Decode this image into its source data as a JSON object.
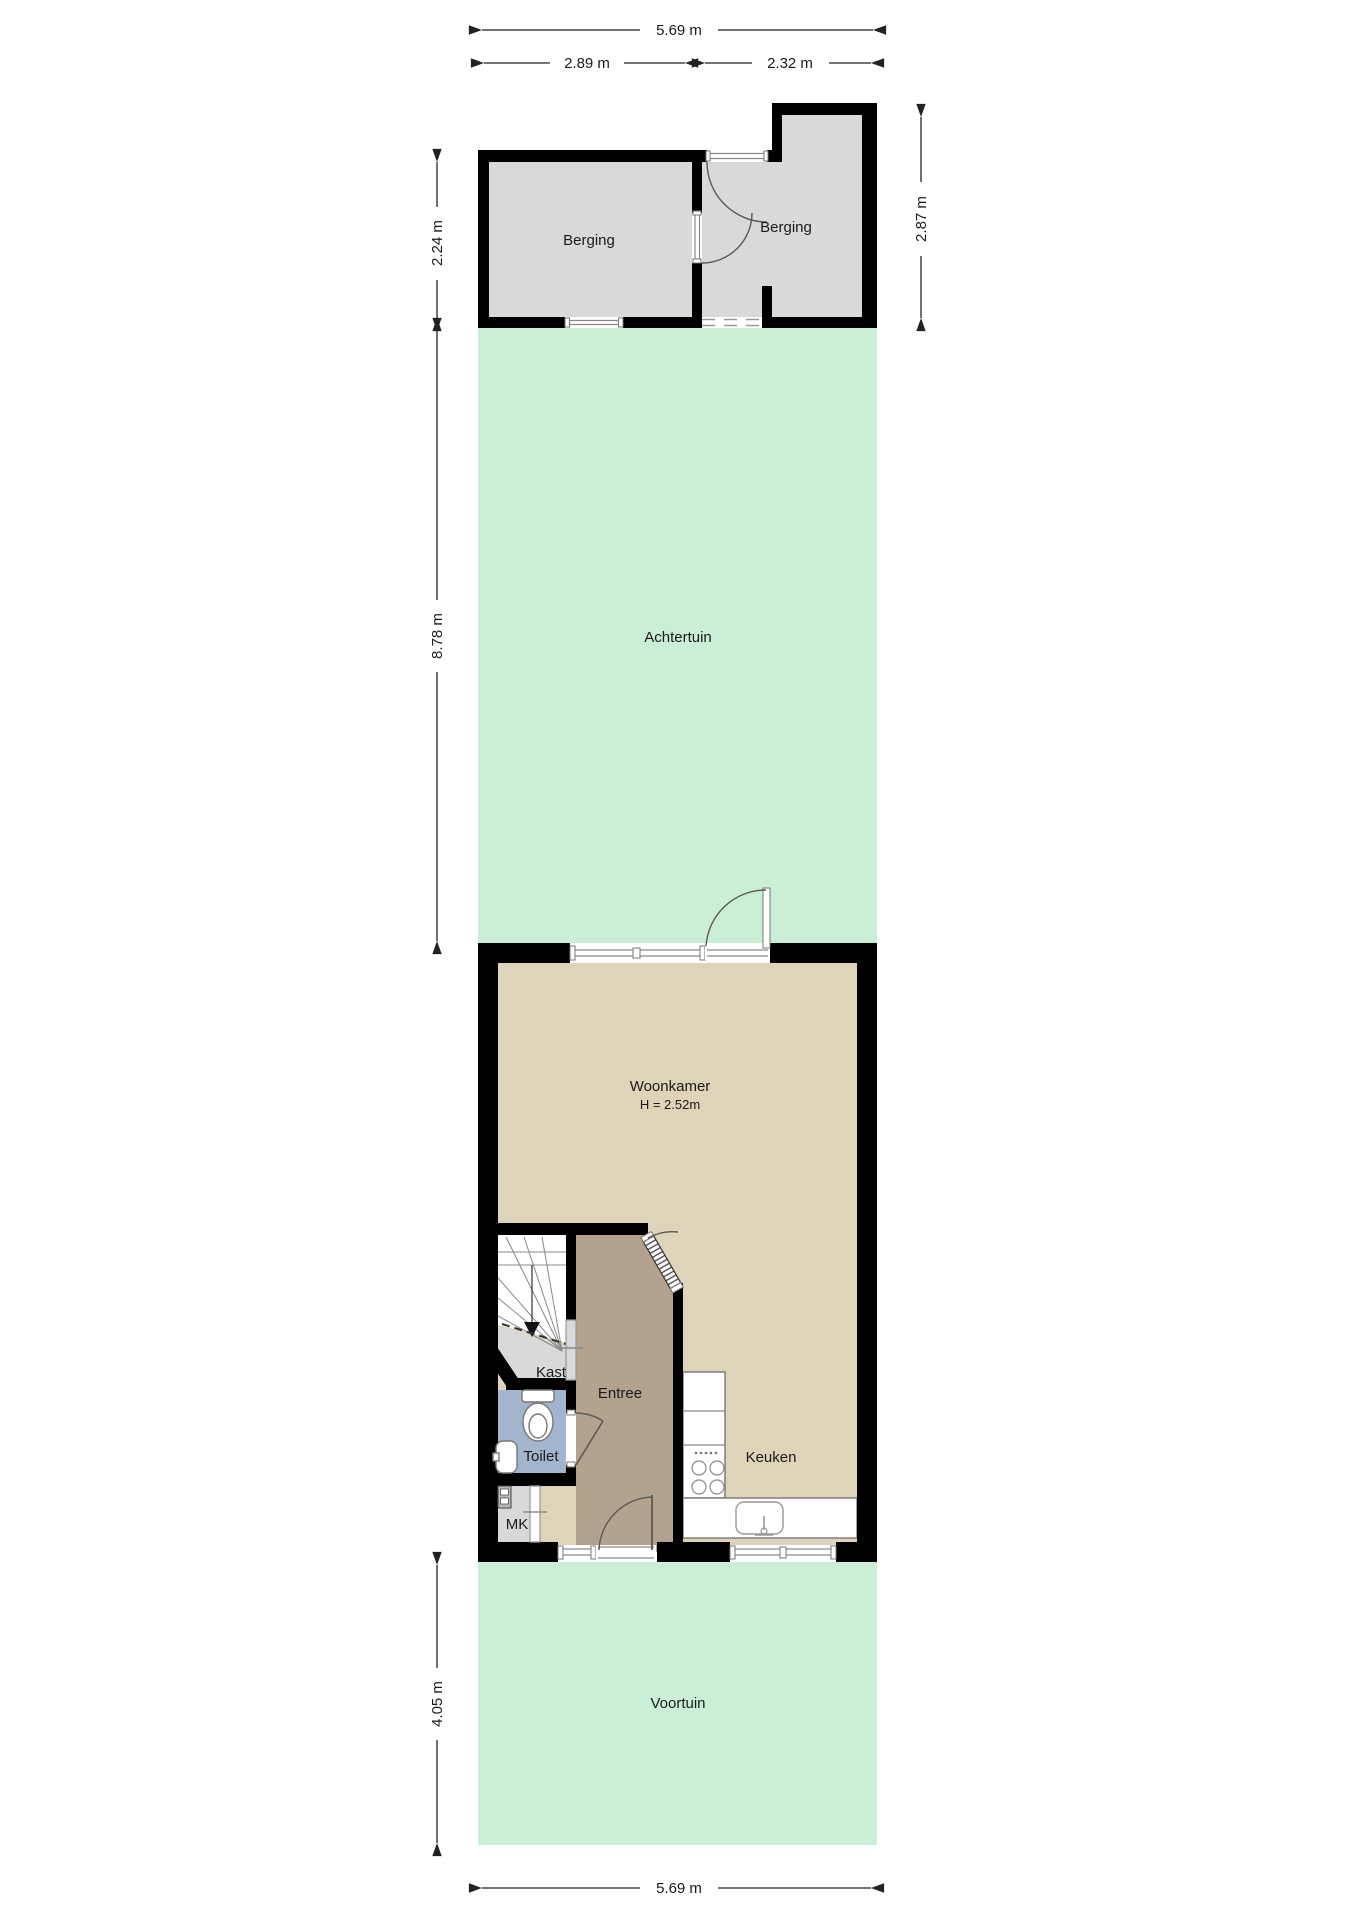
{
  "title": "Begane grond plattegrond",
  "rooms": {
    "berging_left": "Berging",
    "berging_right": "Berging",
    "achtertuin": "Achtertuin",
    "woonkamer": "Woonkamer",
    "woonkamer_height": "H = 2.52m",
    "kast": "Kast",
    "entree": "Entree",
    "toilet": "Toilet",
    "mk": "MK",
    "keuken": "Keuken",
    "voortuin": "Voortuin"
  },
  "dimensions": {
    "top_total": "5.69 m",
    "top_left": "2.89 m",
    "top_right": "2.32 m",
    "berging_depth": "2.24 m",
    "berging_right_depth": "2.87 m",
    "achtertuin_depth": "8.78 m",
    "voortuin_depth": "4.05 m",
    "bottom_total": "5.69 m"
  },
  "colors": {
    "garden": "#cbeed6",
    "storage_floor": "#d9d9d9",
    "living_floor": "#ded4ba",
    "hall_floor": "#b3a28e",
    "toilet_floor": "#a3b5cd",
    "closet_floor": "#d9d9d9",
    "wall": "#000000"
  }
}
